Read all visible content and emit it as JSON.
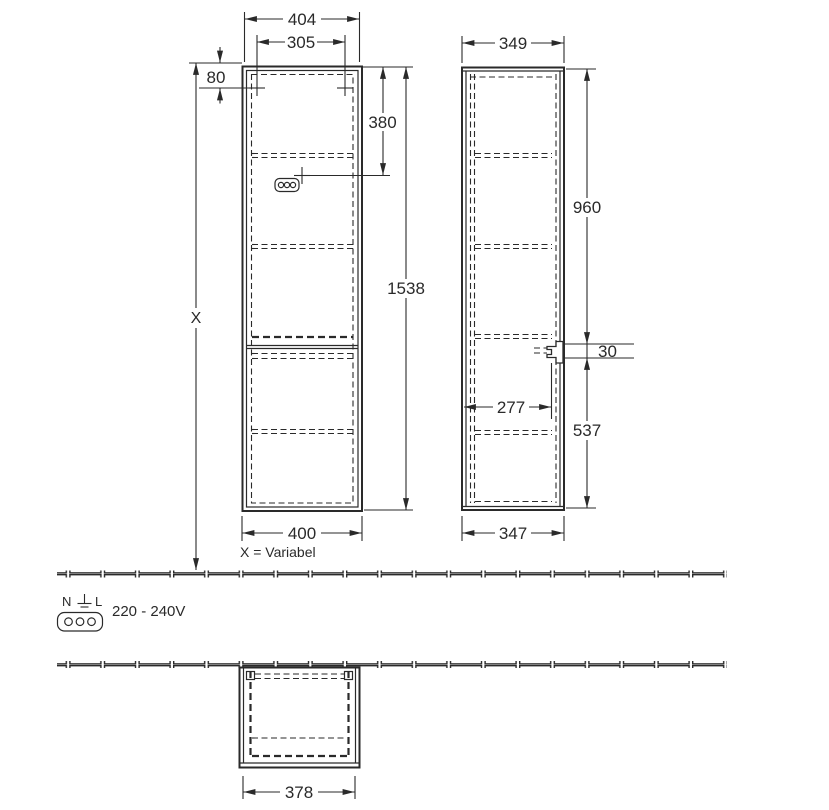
{
  "views": {
    "front": {
      "dims": {
        "outer_width_top": "404",
        "mount_hole_spacing": "305",
        "mount_hole_top_offset": "80",
        "socket_height": "380",
        "total_height": "1538",
        "width_bottom": "400"
      },
      "height_variable_label": "X",
      "height_variable_note": "X = Variabel"
    },
    "side": {
      "dims": {
        "depth_top": "349",
        "upper_section_height": "960",
        "bracket_height": "30",
        "bracket_depth": "277",
        "lower_section_height": "537",
        "depth_bottom": "347"
      }
    },
    "bottom": {
      "dims": {
        "width": "378"
      }
    }
  },
  "electrical": {
    "terminal_n": "N",
    "terminal_l": "L",
    "voltage": "220 - 240V"
  },
  "colors": {
    "line": "#2a2a2a",
    "background": "#ffffff"
  }
}
